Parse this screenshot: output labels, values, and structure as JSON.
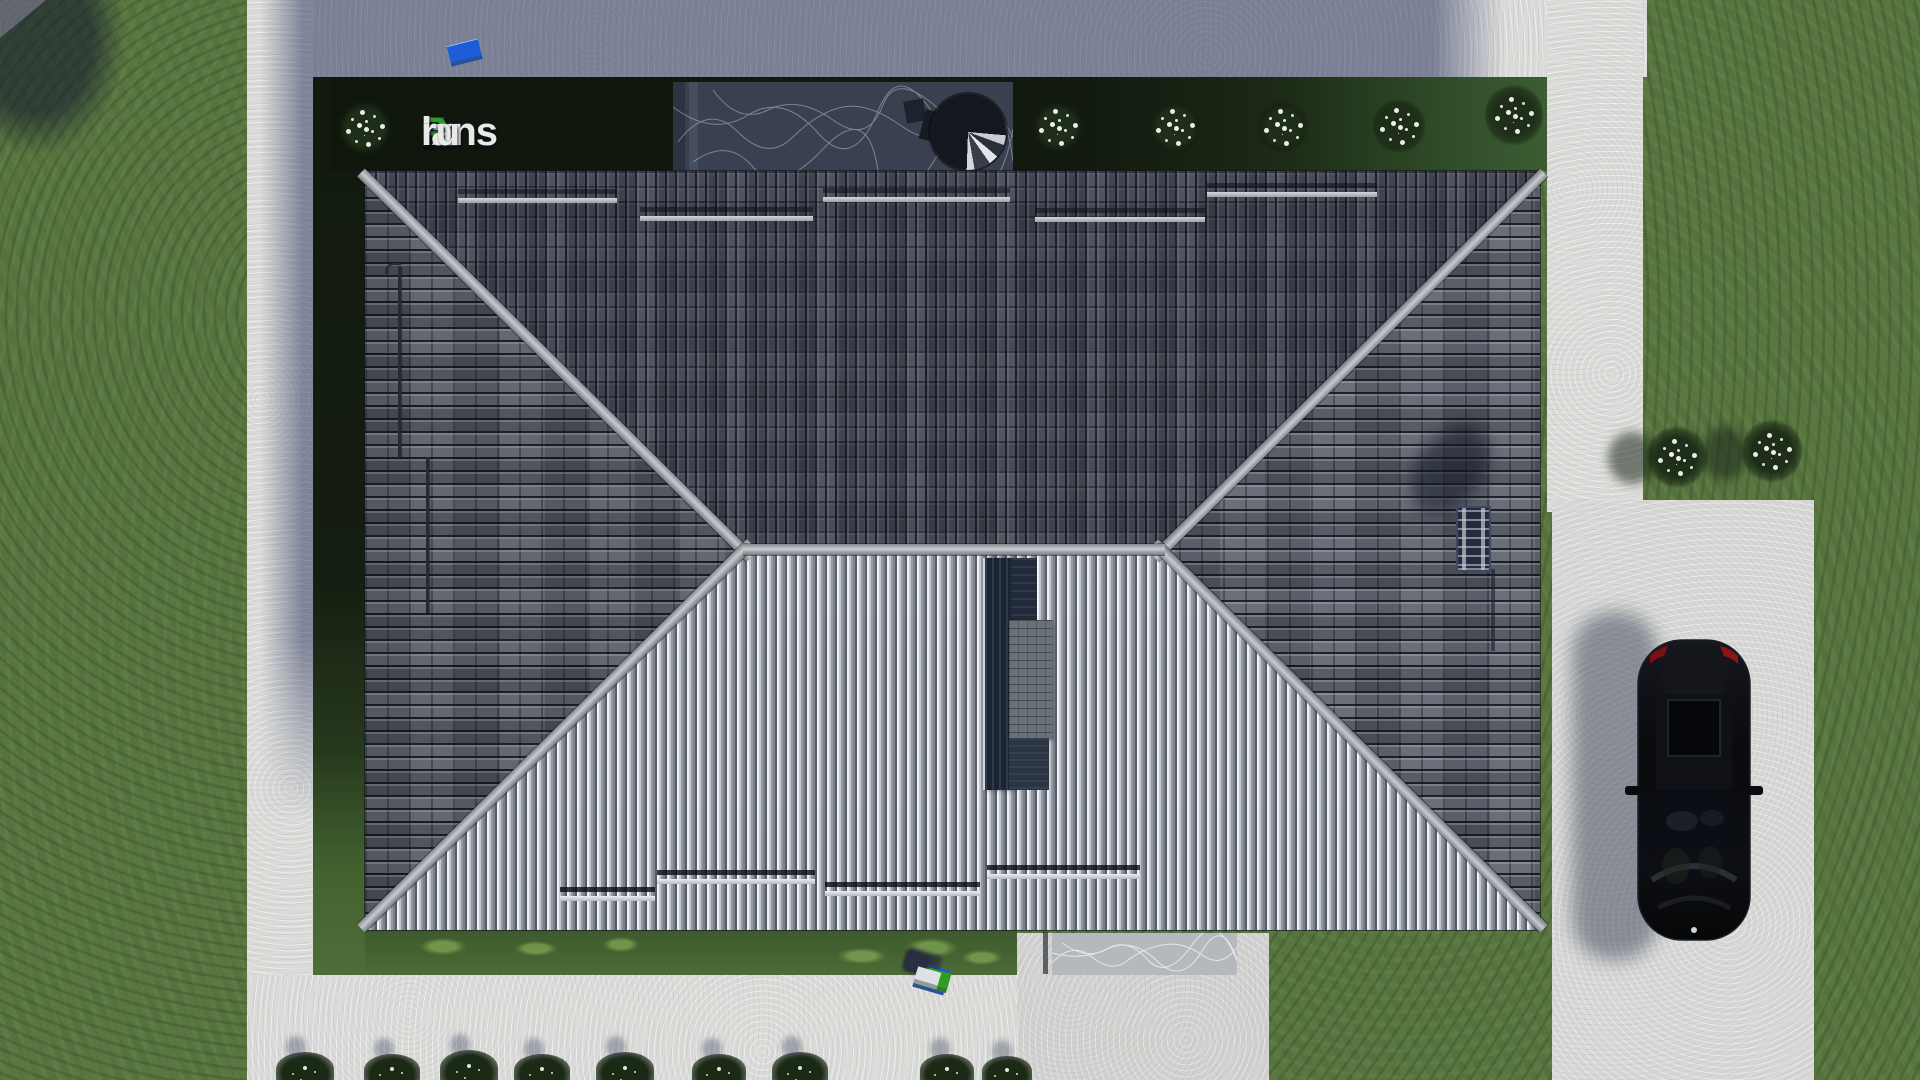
{
  "brand": {
    "name": "FixPlans.ru",
    "letters": [
      {
        "t": "F",
        "c": "#1e5bd8"
      },
      {
        "t": "ix",
        "c": "#e9e9e9"
      },
      {
        "t": "P",
        "c": "#2f9e1e"
      },
      {
        "t": "lans",
        "c": "#e9e9e9"
      },
      {
        "t": ".",
        "c": "#1e5bd8"
      },
      {
        "t": "ru",
        "c": "#e9e9e9"
      }
    ]
  },
  "palette": {
    "grass": "#5a7742",
    "concrete": "#dadbd8",
    "shadowtint": "#1e2855",
    "bed": "#121a0f",
    "roofdark": "#4e525d",
    "rooflight": "#a8adb4",
    "ridge": "#b8bbc0",
    "marbledark": "#394150",
    "marblelight": "#b5b9bd",
    "car": "#0b0c10",
    "blue": "#1e5bd8",
    "green": "#2f9e1e",
    "white": "#dde1e5"
  }
}
